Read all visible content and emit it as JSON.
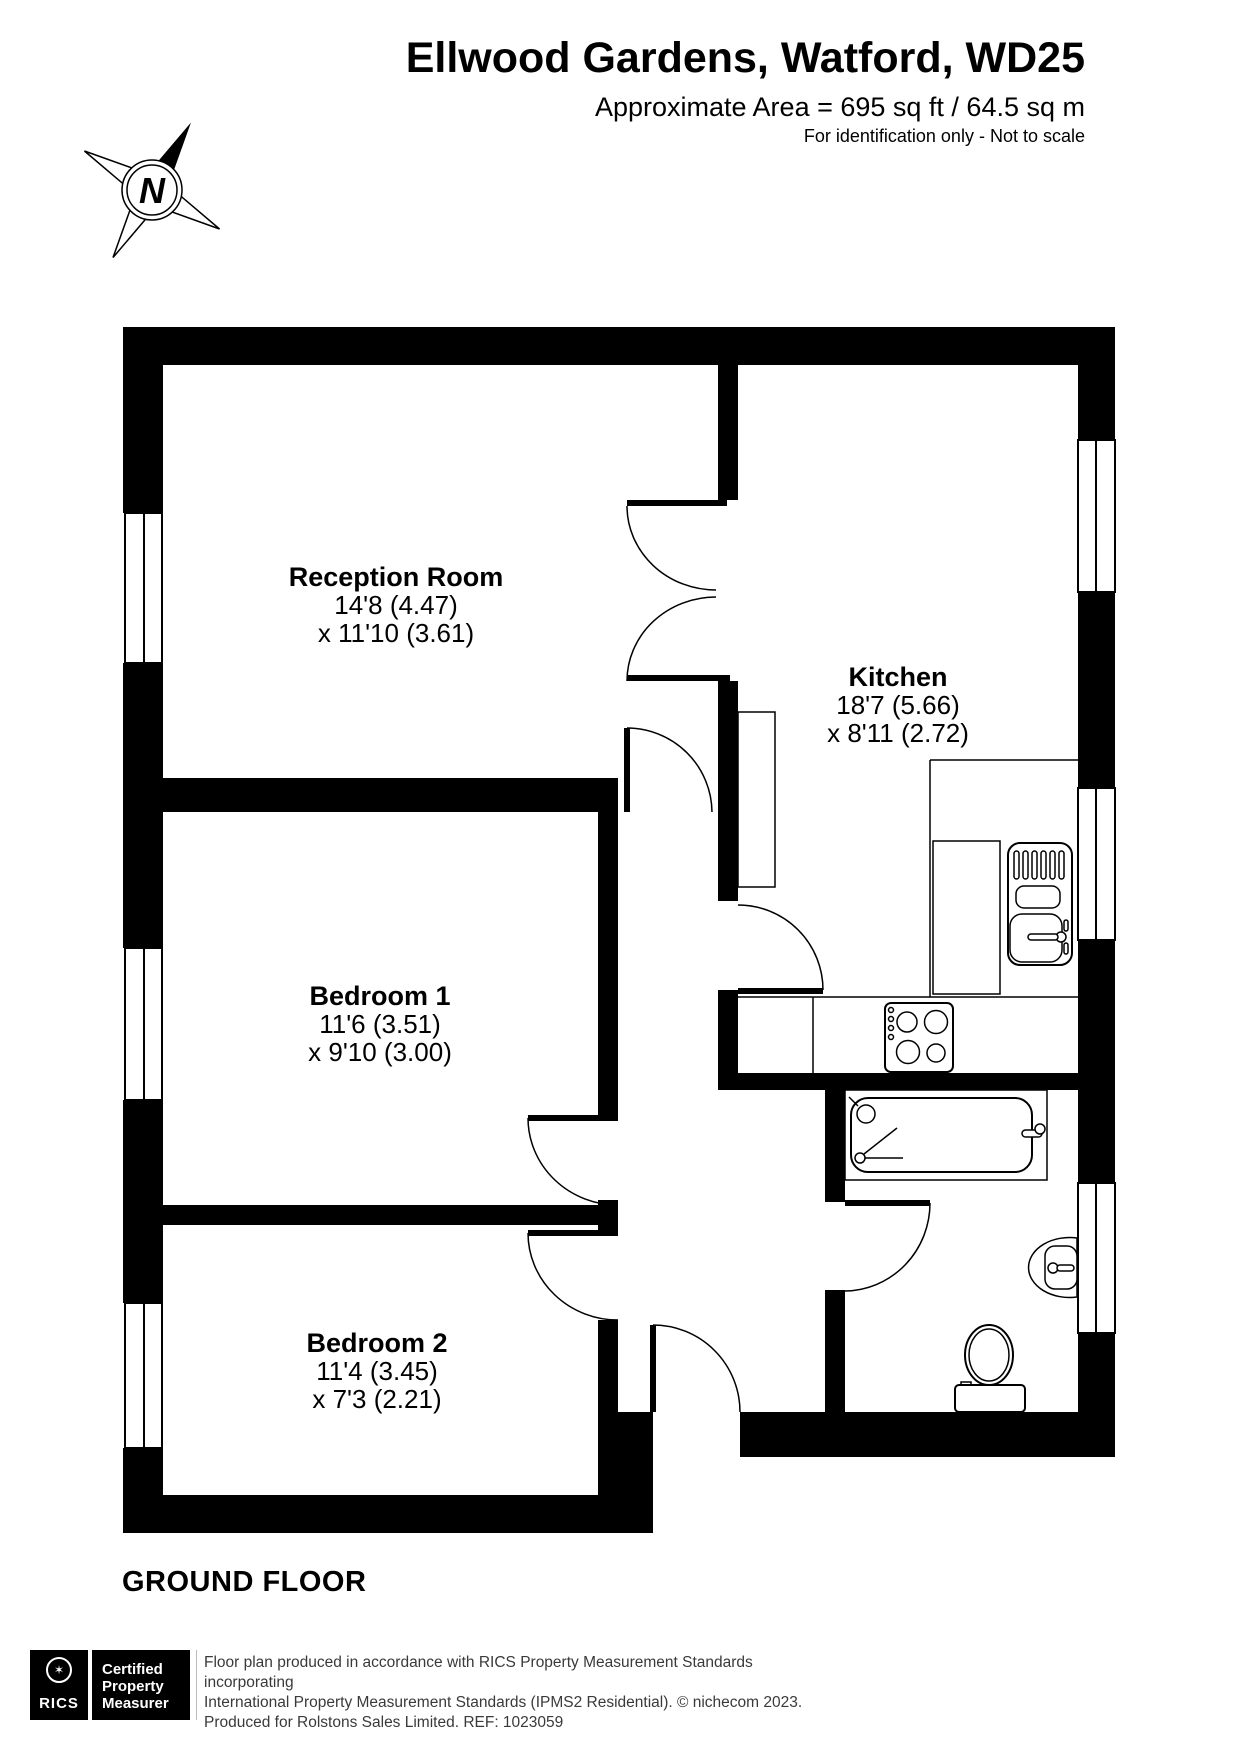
{
  "header": {
    "title": "Ellwood Gardens, Watford, WD25",
    "area": "Approximate Area = 695 sq ft / 64.5 sq m",
    "note": "For identification only - Not to scale"
  },
  "north_arrow": {
    "label": "N"
  },
  "floor_label": "GROUND FLOOR",
  "rooms": [
    {
      "name": "Reception Room",
      "size1": "14'8 (4.47)",
      "size2": "x 11'10 (3.61)"
    },
    {
      "name": "Kitchen",
      "size1": "18'7 (5.66)",
      "size2": "x 8'11 (2.72)"
    },
    {
      "name": "Bedroom 1",
      "size1": "11'6 (3.51)",
      "size2": "x 9'10 (3.00)"
    },
    {
      "name": "Bedroom 2",
      "size1": "11'4 (3.45)",
      "size2": "x 7'3 (2.21)"
    }
  ],
  "fixtures": [
    "bath",
    "toilet",
    "wash-basin",
    "kitchen-sink",
    "hob",
    "kitchen-counter",
    "tall-unit",
    "windows",
    "door-swings"
  ],
  "footer": {
    "logo": {
      "brand": "RICS",
      "lines": [
        "Certified",
        "Property",
        "Measurer"
      ]
    },
    "disclaimer": [
      "Floor plan produced in accordance with RICS Property Measurement Standards incorporating",
      "International Property Measurement Standards (IPMS2 Residential).   © nichecom 2023.",
      "Produced for Rolstons Sales Limited.   REF:  1023059"
    ]
  },
  "colors": {
    "wall": "#000000",
    "background": "#ffffff",
    "line": "#000000"
  }
}
